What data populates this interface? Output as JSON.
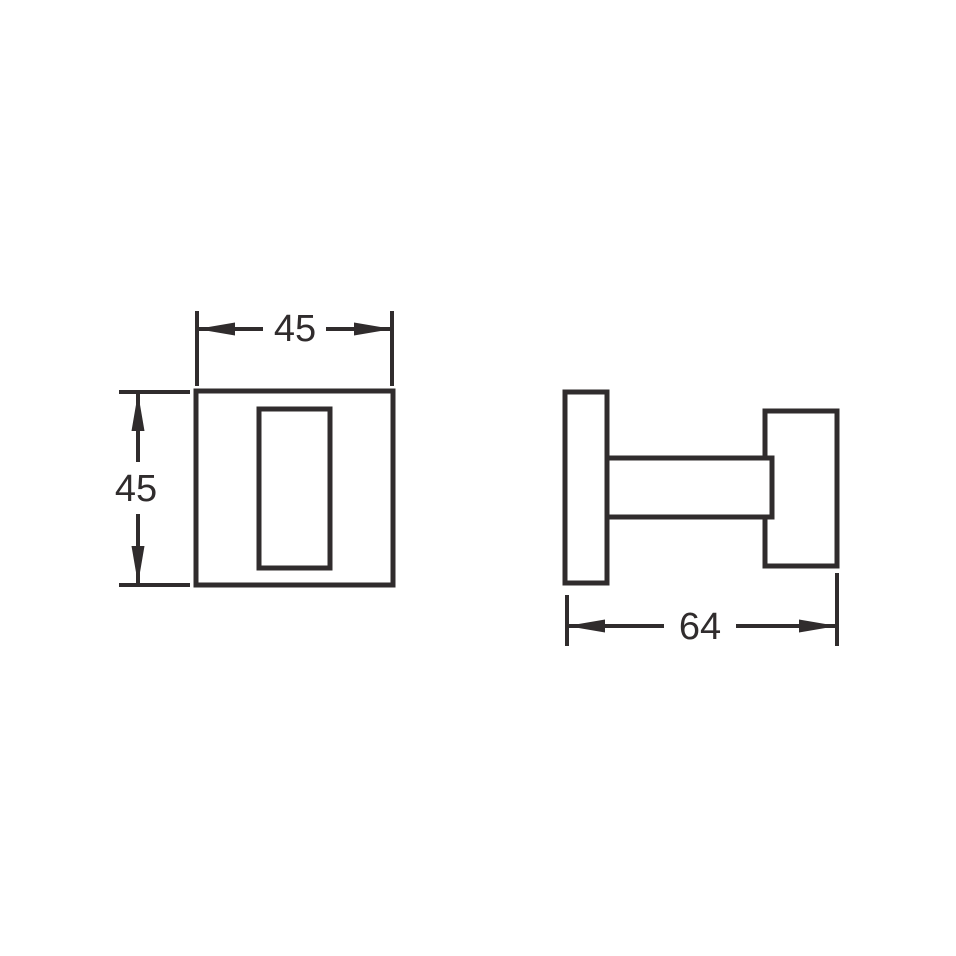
{
  "drawing": {
    "line_color": "#302c2d",
    "background_color": "#ffffff",
    "front_view": {
      "width_dim": "45",
      "height_dim": "45"
    },
    "side_view": {
      "depth_dim": "64"
    }
  }
}
